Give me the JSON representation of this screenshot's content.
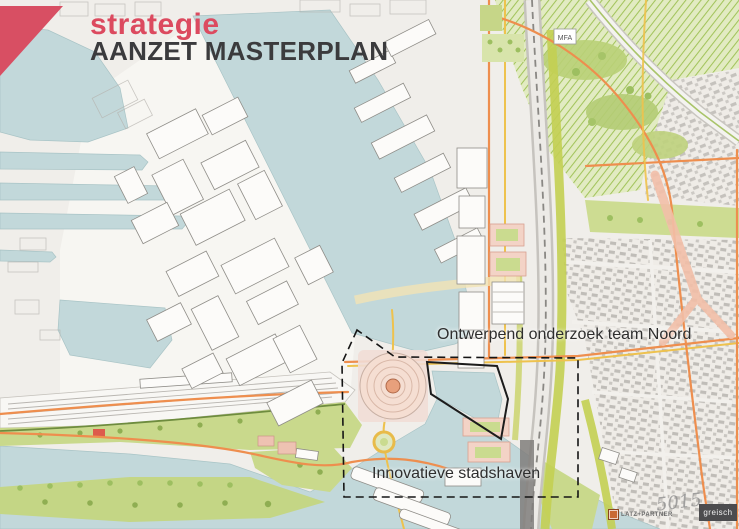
{
  "header": {
    "line1": "strategie",
    "line2": "AANZET MASTERPLAN"
  },
  "annotations": {
    "north_label": "Ontwerpend onderzoek team Noord",
    "harbor_label": "Innovatieve stadshaven",
    "building_label": "MFA"
  },
  "credits": {
    "landscape_firm": "LATZ+PARTNER",
    "signature_mark": "5015",
    "engineering_firm": "greisch"
  },
  "colors": {
    "brand_pink": "#d84f63",
    "title_dark": "#3b3b3d",
    "water": "#c2d8da",
    "park_green": "#c9d98c",
    "hatch_green": "#a3c45c",
    "road_orange": "#ee8e4e",
    "road_yellow": "#eec24e",
    "residential_pink": "#f2d3c6",
    "label_dark": "#2e2e2e",
    "greisch_bg": "#4c4c4e"
  }
}
